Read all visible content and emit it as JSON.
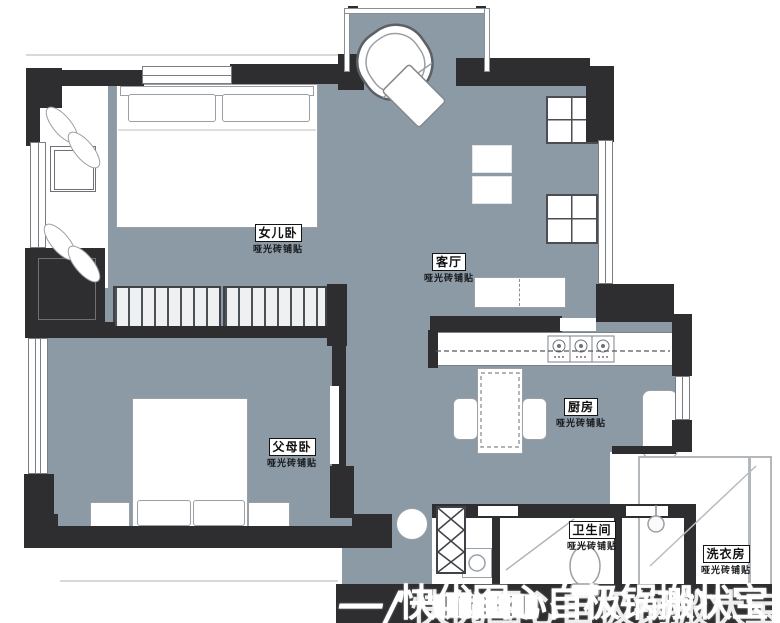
{
  "palette": {
    "floor": "#8C9AA6",
    "wall": "#2E2E30",
    "line": "#8a8f94",
    "label_border": "#141414",
    "watermark": "#ffffff"
  },
  "rooms": [
    {
      "name": "女儿卧",
      "finish": "哑光砖铺贴"
    },
    {
      "name": "客厅",
      "finish": "哑光砖铺贴"
    },
    {
      "name": "父母卧",
      "finish": "哑光砖铺贴"
    },
    {
      "name": "厨房",
      "finish": "哑光砖铺贴"
    },
    {
      "name": "卫生间",
      "finish": "哑光砖铺贴"
    },
    {
      "name": "洗衣房",
      "finish": "哑光砖铺贴"
    }
  ],
  "watermark": {
    "prefix": "一/",
    "text": "快优图心自极锅搬状宝"
  }
}
